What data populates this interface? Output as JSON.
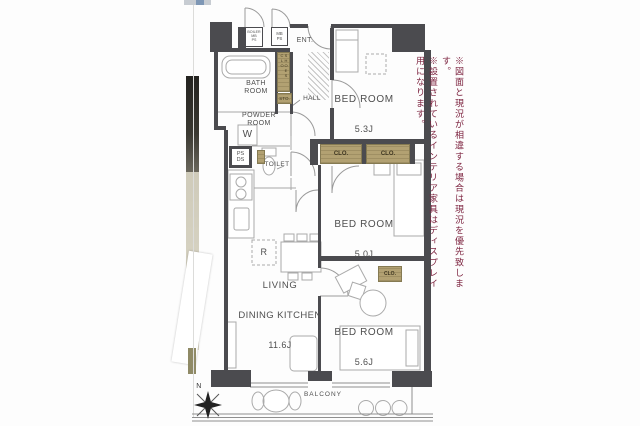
{
  "colors": {
    "wall": "#4b4b4f",
    "closet": "#b2a172",
    "line": "#9a9a9a",
    "label": "#4f4f4f",
    "note_text": "#7d2440"
  },
  "notes": {
    "line1": "※図面と現況が相違する場合は現況を優先致します。",
    "line2": "※設置されているインテリア家具はディスプレイ用になります。"
  },
  "rooms": {
    "bedroom_1": {
      "name": "BED ROOM",
      "size": "5.3J"
    },
    "bedroom_2": {
      "name": "BED ROOM",
      "size": "5.0J"
    },
    "bedroom_3": {
      "name": "BED ROOM",
      "size": "5.6J"
    },
    "ldk": {
      "name_line1": "LIVING",
      "name_line2": "DINING KITCHEN",
      "size": "11.6J"
    },
    "bath": {
      "name": "BATH\nROOM"
    },
    "powder": {
      "name": "POWDER\nROOM"
    },
    "toilet": {
      "name": "TOILET"
    },
    "hall": {
      "name": "HALL"
    },
    "entrance": {
      "name": "ENT."
    },
    "balcony": {
      "name": "BALCONY"
    }
  },
  "fixtures": {
    "boiler": "BOILER\nMB\nPS",
    "mbps": "MB\nPS",
    "psds": "PS\nDS",
    "washer": "W",
    "fridge": "R",
    "shoes_closet": "SHOES CLO",
    "storage": "STO.",
    "closet": "CLO."
  },
  "compass": {
    "north": "N"
  }
}
